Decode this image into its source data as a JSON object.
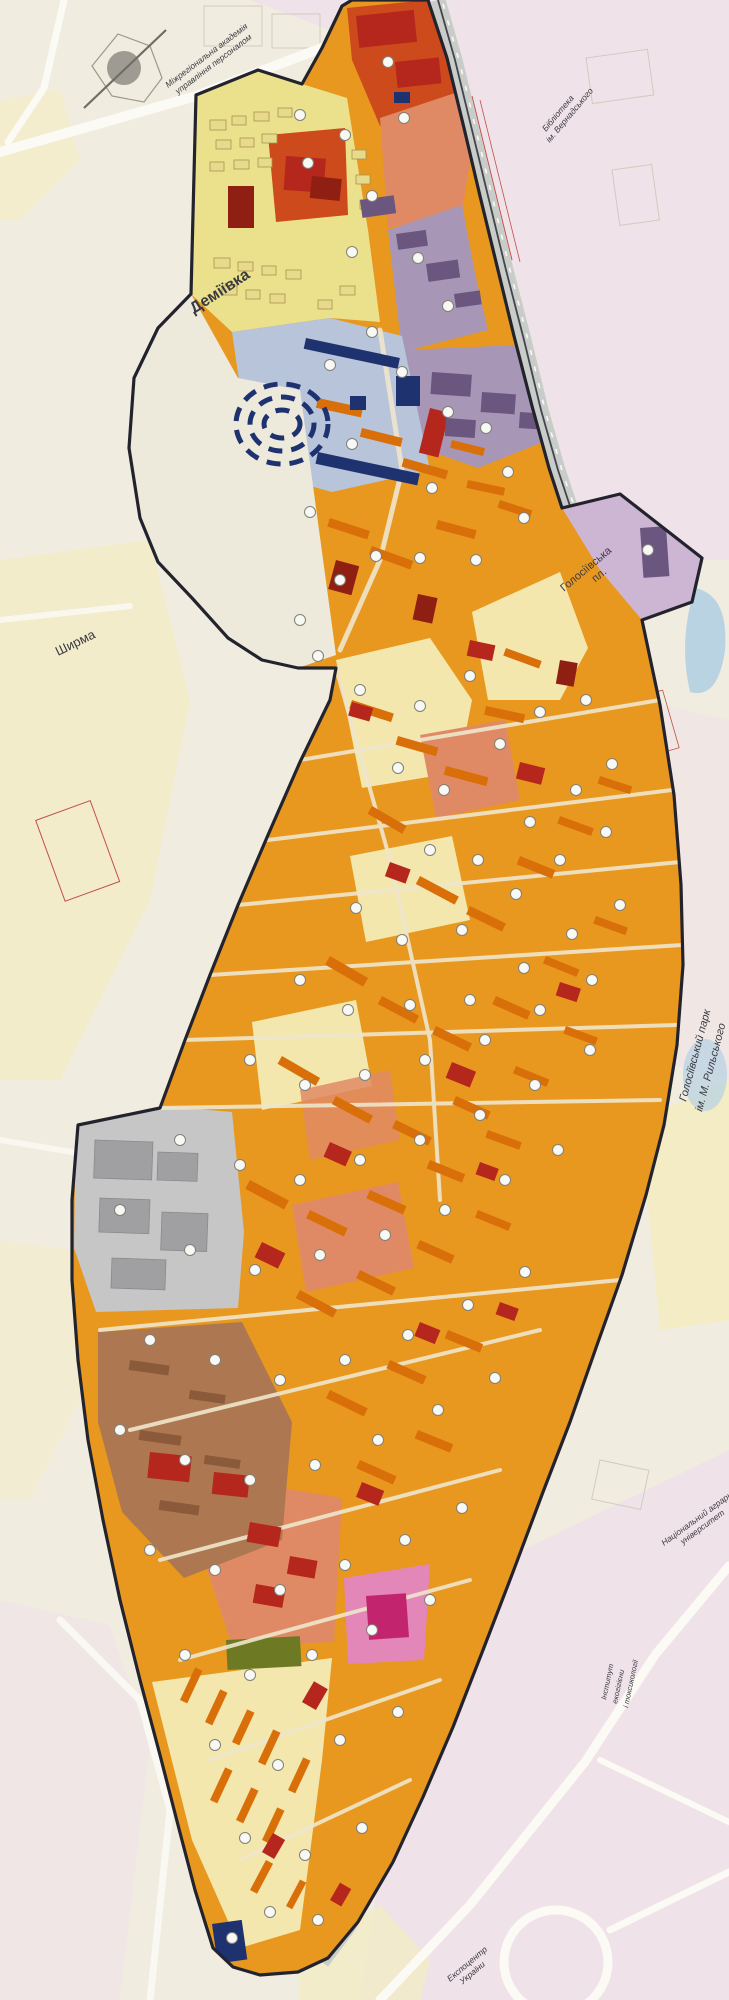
{
  "map": {
    "labels": {
      "academy": {
        "line1": "Міжрегіональна академія",
        "line2": "управління персоналом"
      },
      "library": {
        "line1": "Бібліотека",
        "line2": "ім. Вернадського"
      },
      "demiivka": {
        "text": "Деміївка"
      },
      "square": {
        "line1": "Голосіївська",
        "line2": "пл."
      },
      "shyrma": {
        "text": "Ширма"
      },
      "park": {
        "line1": "Голосіївський парк",
        "line2": "ім. М. Рильського"
      },
      "university": {
        "line1": "Національний аграрний",
        "line2": "університет"
      },
      "institute": {
        "line1": "Інститут",
        "line2": "екогігієни",
        "line3": "і токсикології"
      },
      "expocentre": {
        "line1": "Експоцентр",
        "line2": "України"
      }
    },
    "palette": {
      "base_bg": "#f1ece0",
      "pink_bg": "#f0e2e9",
      "yellow_bg": "#f3ecc4",
      "water": "#b9d3e3",
      "road_white": "#fbfaf4",
      "road_grey": "#c9cdc9",
      "road_dark": "#44444e",
      "red_line": "#c0504a",
      "outline": "#23232e",
      "orange": "#e8981e",
      "orange_building": "#d96f08",
      "yellow_zone": "#ebe08c",
      "yellow_building": "#e7da8c",
      "yellow_building_stroke": "#a8954a",
      "yellow_light": "#f3e7ad",
      "red_zone": "#cd4a1c",
      "red_building": "#b5261c",
      "dark_red": "#8e1f12",
      "salmon": "#e08a65",
      "purple": "#a796b6",
      "purple_building": "#6b5680",
      "lavender": "#cdb6d4",
      "blue_zone": "#b7c4da",
      "navy": "#1f3270",
      "grey_zone": "#c6c6c6",
      "grey_building": "#a0a0a2",
      "brown": "#ad7851",
      "brown_building": "#8a5a3a",
      "pink_zone": "#e287b7",
      "magenta": "#c2256e",
      "olive": "#6d7a23",
      "hatch_line": "#c6c2b4",
      "hatch_bg": "#edeadb",
      "inner_street": "#efe6cc",
      "marker_fill": "#f8f8f4",
      "marker_stroke": "#808078",
      "label_dark": "#1a1a1a",
      "label_grey": "#4a4a50"
    },
    "markers": [
      [
        300,
        115
      ],
      [
        345,
        135
      ],
      [
        308,
        163
      ],
      [
        388,
        62
      ],
      [
        404,
        118
      ],
      [
        372,
        196
      ],
      [
        352,
        252
      ],
      [
        418,
        258
      ],
      [
        448,
        306
      ],
      [
        372,
        332
      ],
      [
        330,
        365
      ],
      [
        402,
        372
      ],
      [
        448,
        412
      ],
      [
        486,
        428
      ],
      [
        508,
        472
      ],
      [
        432,
        488
      ],
      [
        352,
        444
      ],
      [
        310,
        512
      ],
      [
        340,
        580
      ],
      [
        376,
        556
      ],
      [
        420,
        558
      ],
      [
        300,
        620
      ],
      [
        318,
        656
      ],
      [
        476,
        560
      ],
      [
        524,
        518
      ],
      [
        648,
        550
      ],
      [
        360,
        690
      ],
      [
        420,
        706
      ],
      [
        470,
        676
      ],
      [
        398,
        768
      ],
      [
        444,
        790
      ],
      [
        500,
        744
      ],
      [
        540,
        712
      ],
      [
        586,
        700
      ],
      [
        430,
        850
      ],
      [
        478,
        860
      ],
      [
        530,
        822
      ],
      [
        576,
        790
      ],
      [
        612,
        764
      ],
      [
        356,
        908
      ],
      [
        402,
        940
      ],
      [
        462,
        930
      ],
      [
        516,
        894
      ],
      [
        560,
        860
      ],
      [
        606,
        832
      ],
      [
        300,
        980
      ],
      [
        348,
        1010
      ],
      [
        410,
        1005
      ],
      [
        470,
        1000
      ],
      [
        524,
        968
      ],
      [
        572,
        934
      ],
      [
        620,
        905
      ],
      [
        250,
        1060
      ],
      [
        305,
        1085
      ],
      [
        365,
        1075
      ],
      [
        425,
        1060
      ],
      [
        485,
        1040
      ],
      [
        540,
        1010
      ],
      [
        592,
        980
      ],
      [
        180,
        1140
      ],
      [
        240,
        1165
      ],
      [
        300,
        1180
      ],
      [
        360,
        1160
      ],
      [
        420,
        1140
      ],
      [
        480,
        1115
      ],
      [
        535,
        1085
      ],
      [
        590,
        1050
      ],
      [
        120,
        1210
      ],
      [
        190,
        1250
      ],
      [
        255,
        1270
      ],
      [
        320,
        1255
      ],
      [
        385,
        1235
      ],
      [
        445,
        1210
      ],
      [
        505,
        1180
      ],
      [
        558,
        1150
      ],
      [
        150,
        1340
      ],
      [
        215,
        1360
      ],
      [
        280,
        1380
      ],
      [
        345,
        1360
      ],
      [
        408,
        1335
      ],
      [
        468,
        1305
      ],
      [
        525,
        1272
      ],
      [
        120,
        1430
      ],
      [
        185,
        1460
      ],
      [
        250,
        1480
      ],
      [
        315,
        1465
      ],
      [
        378,
        1440
      ],
      [
        438,
        1410
      ],
      [
        495,
        1378
      ],
      [
        150,
        1550
      ],
      [
        215,
        1570
      ],
      [
        280,
        1590
      ],
      [
        345,
        1565
      ],
      [
        405,
        1540
      ],
      [
        462,
        1508
      ],
      [
        185,
        1655
      ],
      [
        250,
        1675
      ],
      [
        312,
        1655
      ],
      [
        372,
        1630
      ],
      [
        430,
        1600
      ],
      [
        215,
        1745
      ],
      [
        278,
        1765
      ],
      [
        340,
        1740
      ],
      [
        398,
        1712
      ],
      [
        245,
        1838
      ],
      [
        305,
        1855
      ],
      [
        362,
        1828
      ],
      [
        270,
        1912
      ],
      [
        318,
        1920
      ],
      [
        232,
        1938
      ]
    ]
  }
}
